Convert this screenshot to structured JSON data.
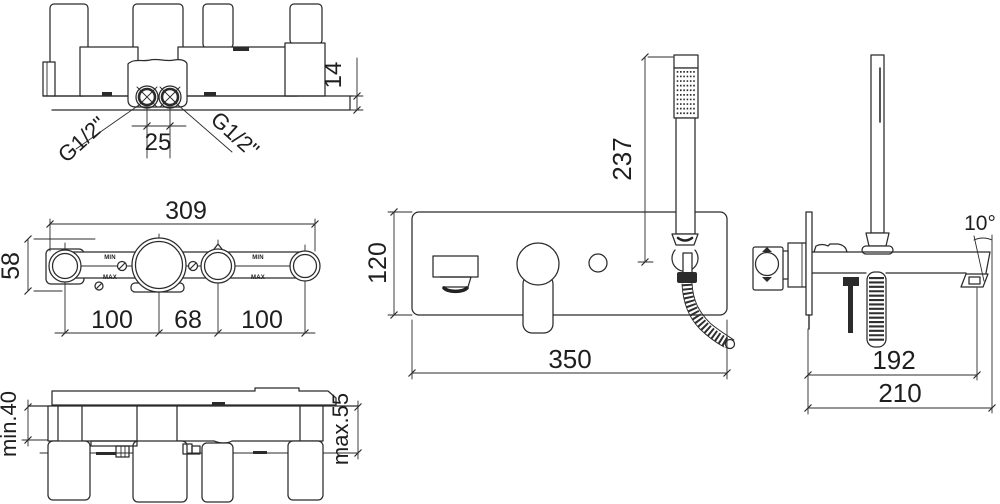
{
  "drawing": {
    "colors": {
      "line": "#2b2b2b",
      "background": "#ffffff"
    },
    "views": {
      "body_top": {
        "labels": {
          "thread_left": "G1/2\"",
          "thread_right": "G1/2\"",
          "port_spacing": "25",
          "wall_offset": "14"
        }
      },
      "body_front": {
        "labels": {
          "total_width": "309",
          "body_height": "58",
          "pitch_left": "100",
          "pitch_center": "68",
          "pitch_right": "100",
          "min_left": "MIN",
          "max_left": "MAX",
          "min_right": "MIN",
          "max_right": "MAX"
        }
      },
      "body_bottom": {
        "labels": {
          "depth_min": "min.40",
          "depth_max": "max.55"
        }
      },
      "trim_front": {
        "labels": {
          "plate_height": "120",
          "plate_width": "350",
          "handshower_length": "237"
        }
      },
      "trim_side": {
        "labels": {
          "spout_angle": "10°",
          "spout_projection": "192",
          "total_projection": "210"
        }
      }
    }
  }
}
